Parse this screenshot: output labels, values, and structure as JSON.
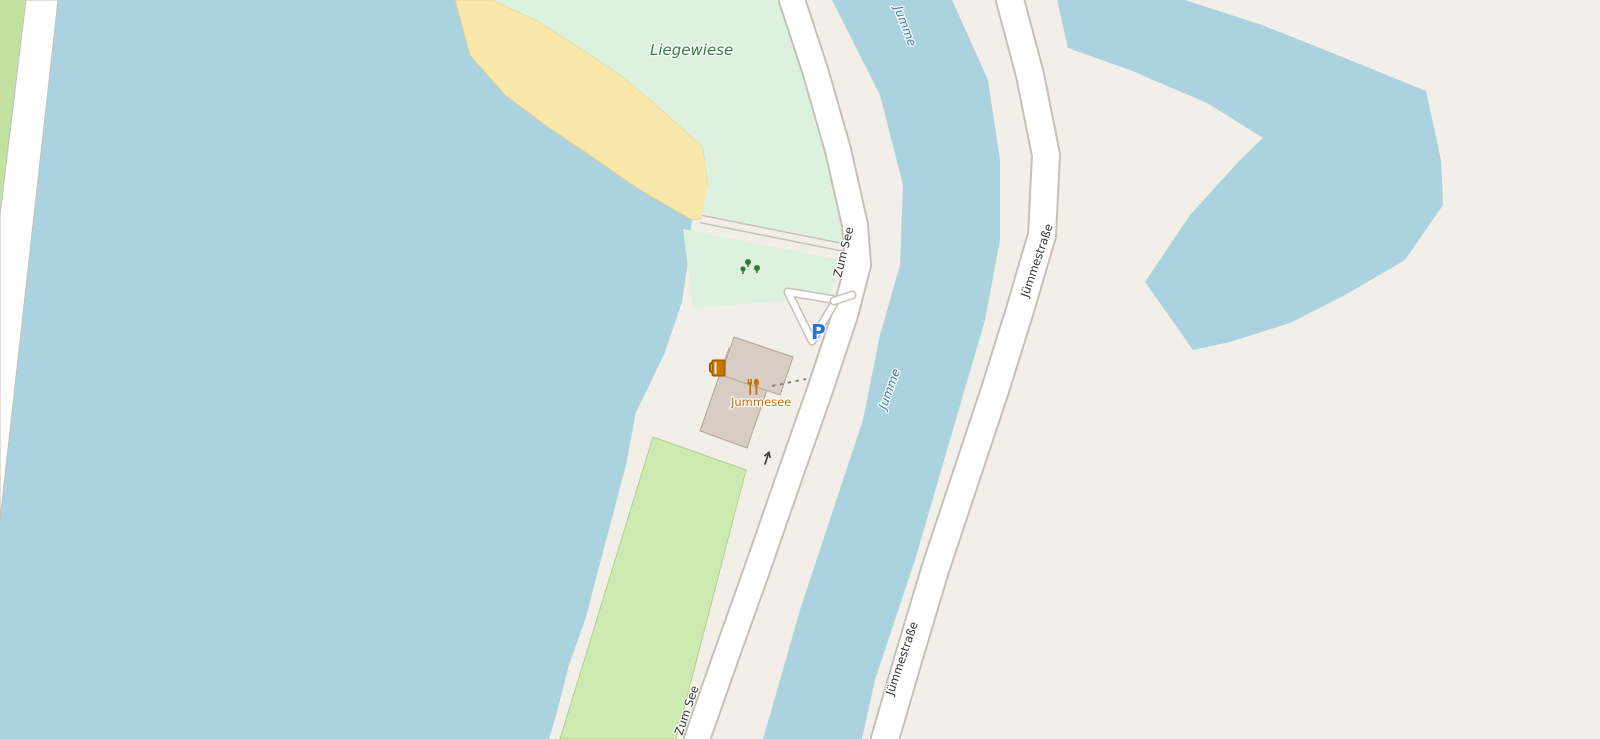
{
  "map": {
    "labels": {
      "meadow": "Liegewiese",
      "river": "Jumme",
      "road_zum_see": "Zum See",
      "road_juemmestrasse": "Jümmestraße",
      "poi_jummesee": "Jummesee",
      "parking": "P"
    },
    "icons": [
      {
        "name": "biergarten-icon",
        "meaning": "beer garden (beer mug)"
      },
      {
        "name": "restaurant-icon",
        "meaning": "restaurant (fork and spoon)"
      },
      {
        "name": "tree-icon",
        "meaning": "trees in park"
      },
      {
        "name": "parking-icon",
        "meaning": "parking"
      },
      {
        "name": "oneway-arrow-icon",
        "meaning": "one-way road arrow"
      }
    ],
    "colors": {
      "land": "#f2efe9",
      "water": "#aad3df",
      "meadow": "#dcf2df",
      "grass": "#cdebb0",
      "grass_border": "#b2cf8e",
      "greenstrip": "#c4e29f",
      "beach": "#fae8ab",
      "beach_border": "#e0cd8f",
      "building": "#d7cdc5",
      "building_outline": "#b5a294",
      "road_casing": "#c6c1b7",
      "road_fill": "#ffffff",
      "footpath": "#8d7a6a",
      "label_green": "#3d7a42",
      "label_water": "#4d7fa8",
      "label_road": "#333333",
      "label_poi": "#c07310",
      "parking_blue": "#2a72d8",
      "poi_amber": "#c77400",
      "tree_green": "#2e7d32"
    }
  }
}
